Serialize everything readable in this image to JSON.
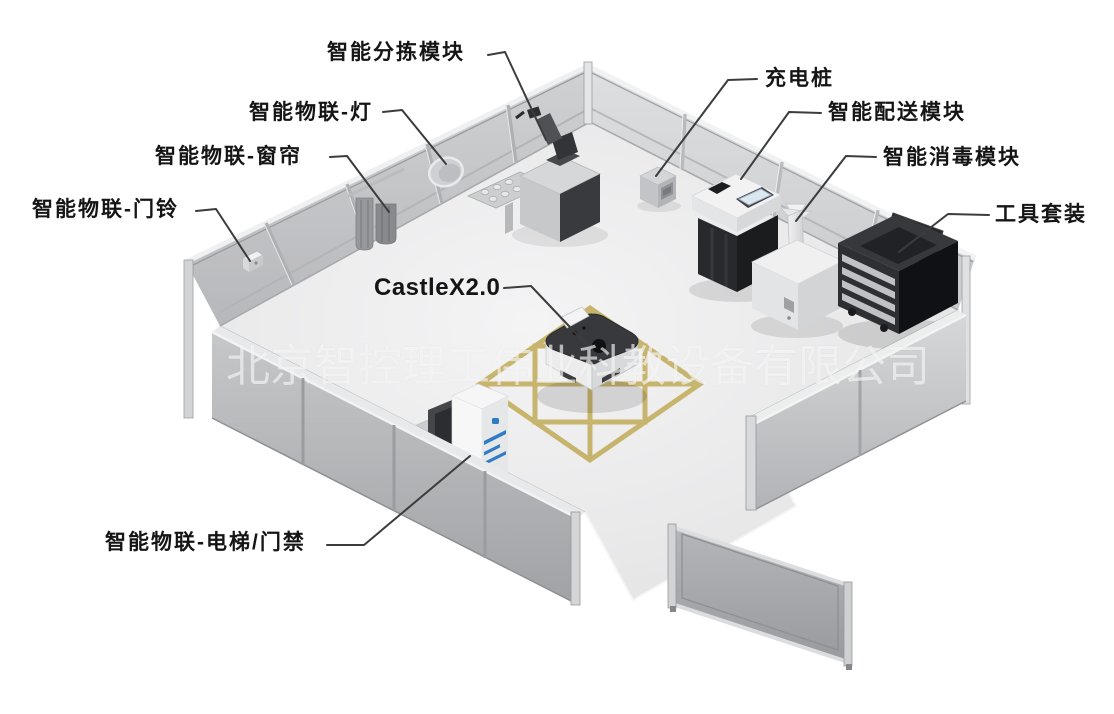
{
  "diagram": {
    "kind": "labeled isometric demo-room diagram",
    "watermark": {
      "text": "北京智控理工伟业科教设备有限公司"
    },
    "labels": [
      {
        "id": "sorting-module",
        "text": "智能分拣模块"
      },
      {
        "id": "iot-light",
        "text": "智能物联-灯"
      },
      {
        "id": "iot-curtain",
        "text": "智能物联-窗帘"
      },
      {
        "id": "iot-doorbell",
        "text": "智能物联-门铃"
      },
      {
        "id": "charging-pile",
        "text": "充电桩"
      },
      {
        "id": "delivery-module",
        "text": "智能配送模块"
      },
      {
        "id": "disinfection-module",
        "text": "智能消毒模块"
      },
      {
        "id": "tool-kit",
        "text": "工具套装"
      },
      {
        "id": "robot-castlex",
        "text": "CastleX2.0"
      },
      {
        "id": "elevator-access",
        "text": "智能物联-电梯/门禁"
      }
    ],
    "colors": {
      "label_text": "#151515",
      "leader_line": "#3c3c3c",
      "floor": "#e9e9ea",
      "wall_back_left": "#c6c7ca",
      "wall_back_right": "#d7d8da",
      "front_wall": "#b4b6b9",
      "tape_yellow": "#c3ae5f",
      "accent_blue": "#2f7cc3",
      "equipment_dark": "#2a2b2e",
      "watermark": "rgba(255,255,255,0.62)"
    }
  }
}
